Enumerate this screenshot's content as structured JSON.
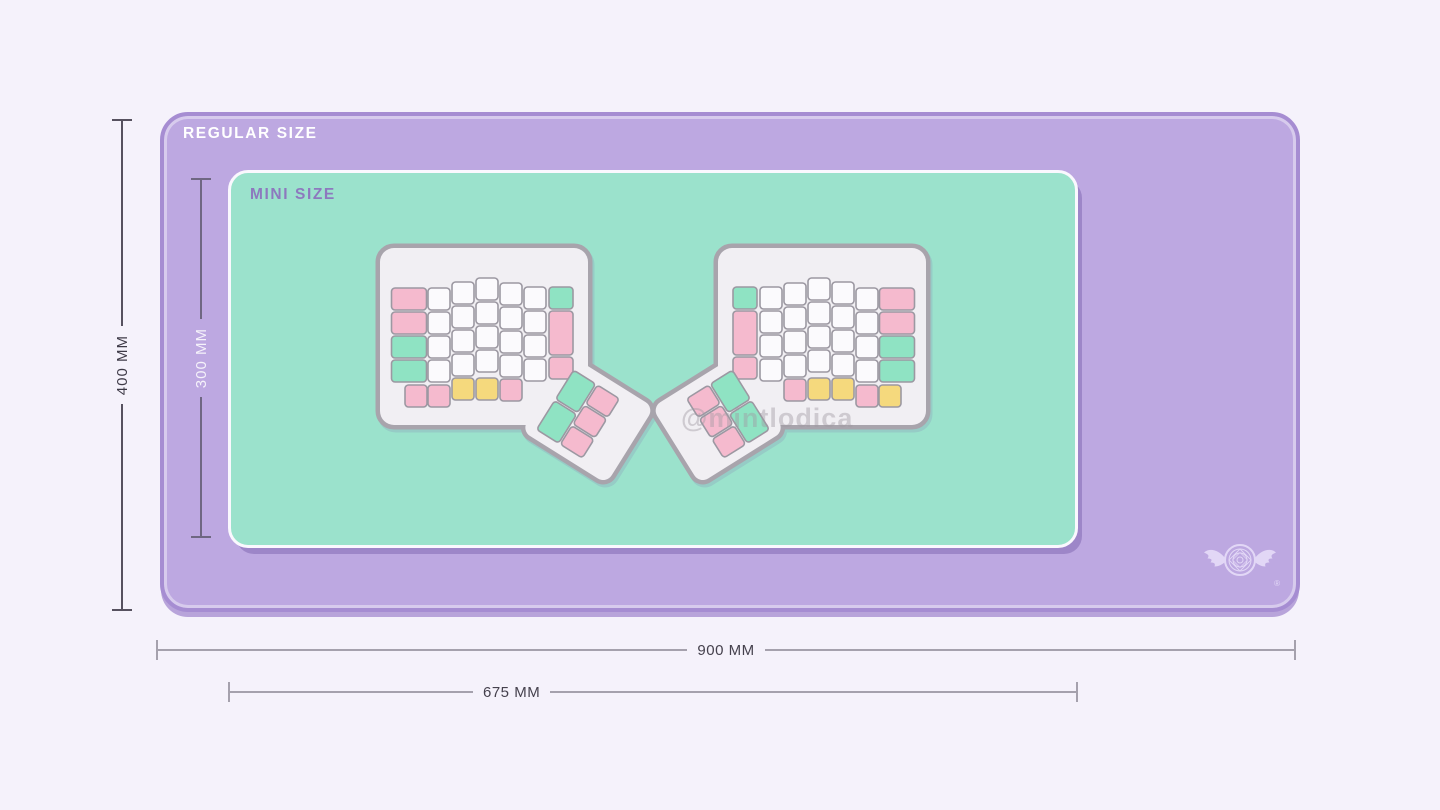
{
  "colors": {
    "background": "#F5F2FB",
    "mat_regular_fill": "#BDA8E1",
    "mat_regular_border": "#A68DD2",
    "mat_mini_fill": "#9BE2CC",
    "mat_mini_border": "#FAF8FE",
    "regular_label_color": "#FFFFFF",
    "mini_label_color": "#8D79BE",
    "dim_dark_line": "#56515F",
    "dim_dark_text": "#3E3A47",
    "dim_inner_line": "#6F6782",
    "dim_inner_text": "#F5F2FA",
    "dim_bottom_line": "#A5A1AD",
    "dim_bottom_text": "#45414D",
    "watermark_color": "#A099A2",
    "logo_color": "#E9E0FA"
  },
  "regular_mat": {
    "label": "REGULAR SIZE",
    "height_dim": "400 MM",
    "width_dim": "900 MM"
  },
  "mini_mat": {
    "label": "MINI SIZE",
    "height_dim": "300 MM",
    "width_dim": "675 MM"
  },
  "watermark": "@mintlodica",
  "logo": {
    "name": "winged-magic-circle-emblem",
    "registered_mark": "®"
  },
  "keyboard": {
    "box": {
      "w": 290,
      "h": 256
    },
    "case": {
      "x": 10,
      "y": 13,
      "w": 208,
      "h": 177,
      "rx": 14
    },
    "case_fill": "#F1EFF3",
    "case_stroke": "#A8A4AC",
    "case_stroke_w": 4.5,
    "key_stroke": "#9C98A2",
    "key_stroke_w": 1.6,
    "key_rx": 3.5,
    "palette": {
      "white": "#FBFAFD",
      "pink": "#F5BACE",
      "mint": "#8FE3C3",
      "yellow": "#F5D97D"
    },
    "main_keys": [
      {
        "x": 21.5,
        "y": 53,
        "w": 35,
        "c": "pink"
      },
      {
        "x": 21.5,
        "y": 77,
        "w": 35,
        "c": "pink"
      },
      {
        "x": 21.5,
        "y": 101,
        "w": 35,
        "c": "mint"
      },
      {
        "x": 21.5,
        "y": 125,
        "w": 35,
        "c": "mint"
      },
      {
        "x": 58,
        "y": 53,
        "c": "white"
      },
      {
        "x": 58,
        "y": 77,
        "c": "white"
      },
      {
        "x": 58,
        "y": 101,
        "c": "white"
      },
      {
        "x": 58,
        "y": 125,
        "c": "white"
      },
      {
        "x": 82,
        "y": 47,
        "c": "white"
      },
      {
        "x": 82,
        "y": 71,
        "c": "white"
      },
      {
        "x": 82,
        "y": 95,
        "c": "white"
      },
      {
        "x": 82,
        "y": 119,
        "c": "white"
      },
      {
        "x": 82,
        "y": 143,
        "c": "yellow"
      },
      {
        "x": 106,
        "y": 43,
        "c": "white"
      },
      {
        "x": 106,
        "y": 67,
        "c": "white"
      },
      {
        "x": 106,
        "y": 91,
        "c": "white"
      },
      {
        "x": 106,
        "y": 115,
        "c": "white"
      },
      {
        "x": 106,
        "y": 143,
        "c": "yellow"
      },
      {
        "x": 130,
        "y": 48,
        "c": "white"
      },
      {
        "x": 130,
        "y": 72,
        "c": "white"
      },
      {
        "x": 130,
        "y": 96,
        "c": "white"
      },
      {
        "x": 130,
        "y": 120,
        "c": "white"
      },
      {
        "x": 130,
        "y": 144,
        "c": "pink"
      },
      {
        "x": 154,
        "y": 52,
        "c": "white"
      },
      {
        "x": 154,
        "y": 76,
        "c": "white"
      },
      {
        "x": 154,
        "y": 100,
        "c": "white"
      },
      {
        "x": 154,
        "y": 124,
        "c": "white"
      },
      {
        "x": 179,
        "y": 52,
        "w": 24,
        "c": "mint"
      },
      {
        "x": 179,
        "y": 76,
        "w": 24,
        "h": 44,
        "c": "pink"
      },
      {
        "x": 179,
        "y": 122,
        "w": 24,
        "c": "pink"
      },
      {
        "x": 35,
        "y": 150,
        "c": "pink",
        "mc": "yellow"
      },
      {
        "x": 58,
        "y": 150,
        "c": "pink"
      }
    ],
    "thumb": {
      "cx": 219,
      "cy": 186,
      "rot": 32,
      "plate": {
        "x": -52,
        "y": -46,
        "w": 100,
        "h": 90,
        "rx": 10
      },
      "keys": [
        {
          "x": -40,
          "y": -35,
          "w": 26,
          "h": 34,
          "c": "mint"
        },
        {
          "x": -40,
          "y": 1,
          "w": 26,
          "h": 34,
          "c": "mint"
        },
        {
          "x": -12,
          "y": -35,
          "w": 26,
          "h": 22,
          "c": "pink"
        },
        {
          "x": -12,
          "y": -11,
          "w": 26,
          "h": 22,
          "c": "pink"
        },
        {
          "x": -12,
          "y": 13,
          "w": 26,
          "h": 22,
          "c": "pink"
        }
      ]
    }
  }
}
